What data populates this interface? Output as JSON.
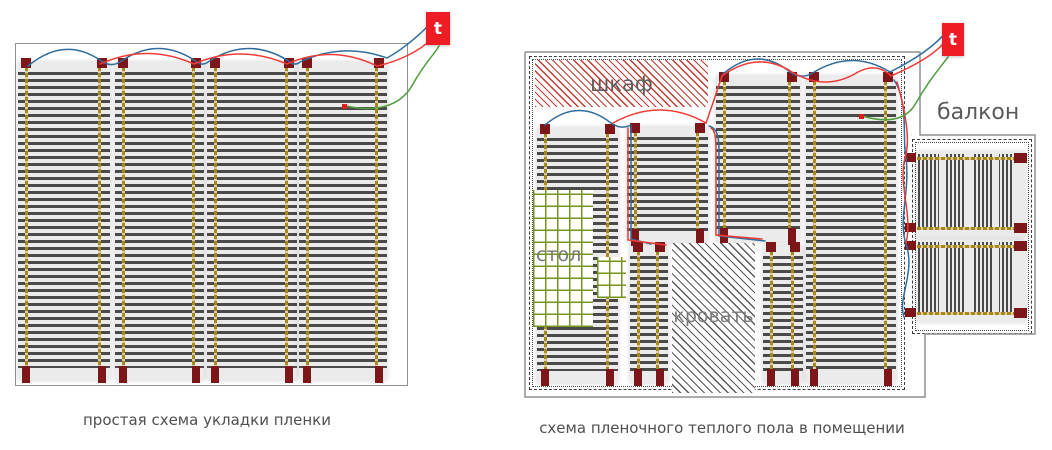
{
  "left_diagram": {
    "caption": "простая схема укладки пленки",
    "caption_pos": {
      "x": 7,
      "y": 411,
      "w": 400
    },
    "thermostat": {
      "label": "t",
      "x": 426,
      "y": 12,
      "w": 24,
      "h": 33
    },
    "border": {
      "x": 15,
      "y": 43,
      "w": 391,
      "h": 341
    },
    "strips": [
      {
        "x": 18,
        "y": 62,
        "w": 92,
        "h": 318
      },
      {
        "x": 115,
        "y": 62,
        "w": 89,
        "h": 318
      },
      {
        "x": 207,
        "y": 62,
        "w": 90,
        "h": 318
      },
      {
        "x": 299,
        "y": 62,
        "w": 88,
        "h": 318
      }
    ],
    "sensor": {
      "x": 342,
      "y": 104
    },
    "wires": {
      "blue": [
        "M28,66 Q64,36 100,60 Q110,68 120,62 Q157,36 194,60 Q201,67 208,62 Q247,36 287,60 Q294,67 300,62 Q343,42 387,58 C405,48 418,36 428,26"
      ],
      "red": [
        "M100,64 Q147,43 194,64 Q240,44 287,64 Q332,44 377,66 C400,61 421,50 430,40"
      ],
      "green": [
        "M346,106 C374,112 400,108 413,84 C424,64 433,56 439,46"
      ]
    }
  },
  "right_diagram": {
    "caption": "схема пленочного теплого пола в помещении",
    "caption_pos": {
      "x": 522,
      "y": 419,
      "w": 400
    },
    "thermostat": {
      "label": "t",
      "x": 942,
      "y": 23,
      "w": 22,
      "h": 33
    },
    "outline_points": "525,52 920,52 920,135 1035,135 1035,334 925,334 925,397 525,397 525,52",
    "room_border": {
      "x": 529,
      "y": 56,
      "w": 374,
      "h": 332
    },
    "room_inner_border": {
      "x": 532,
      "y": 59,
      "w": 368,
      "h": 326
    },
    "wardrobe": {
      "label": "шкаф",
      "x": 535,
      "y": 60,
      "w": 173,
      "h": 47
    },
    "table": {
      "label": "стол",
      "main": {
        "x": 533,
        "y": 190,
        "w": 60,
        "h": 137
      },
      "patch": {
        "x": 597,
        "y": 257,
        "w": 29,
        "h": 41
      },
      "label_pos": {
        "x": 536,
        "y": 244
      }
    },
    "bed": {
      "label": "кровать",
      "x": 672,
      "y": 243,
      "w": 83,
      "h": 150
    },
    "balcony": {
      "label": "балкон",
      "border": {
        "x": 912,
        "y": 139,
        "w": 118,
        "h": 193
      },
      "inner_border": {
        "x": 915,
        "y": 142,
        "w": 112,
        "h": 187
      },
      "label_pos": {
        "x": 937,
        "y": 100
      }
    },
    "strips": [
      {
        "x": 537,
        "y": 128,
        "w": 81,
        "h": 255
      },
      {
        "x": 627,
        "y": 127,
        "w": 81,
        "h": 116
      },
      {
        "x": 630,
        "y": 246,
        "w": 38,
        "h": 137
      },
      {
        "x": 716,
        "y": 76,
        "w": 84,
        "h": 166
      },
      {
        "x": 763,
        "y": 246,
        "w": 40,
        "h": 137
      },
      {
        "x": 806,
        "y": 76,
        "w": 90,
        "h": 307
      }
    ],
    "balcony_strips": [
      {
        "x": 916,
        "y": 152,
        "w": 110,
        "h": 85
      },
      {
        "x": 916,
        "y": 240,
        "w": 110,
        "h": 82
      }
    ],
    "sensor": {
      "x": 859,
      "y": 114
    },
    "wires": {
      "blue": [
        "M545,125 Q578,97 611,123 Q621,130 631,125",
        "M631,127 L631,239 L651,244",
        "M709,126 C716,128 719,134 719,150 L719,236 L765,241",
        "M723,74 Q757,45 790,72 Q800,79 811,74 Q851,48 890,72 C914,60 935,46 947,31",
        "M894,80 C909,102 902,140 906,157 C910,192 899,216 905,241 C917,272 897,297 904,317"
      ],
      "red": [
        "M613,123 Q660,97 706,123",
        "M628,128 L628,240 L666,245",
        "M706,123 C713,103 718,88 722,76",
        "M722,76 Q758,50 792,72 Q826,92 858,72 Q877,62 891,76 C914,66 933,55 943,44",
        "M711,128 C716,131 716,140 716,155 L716,235 L762,239",
        "M897,82 C905,110 911,140 905,158 C898,185 913,215 906,243"
      ],
      "green": [
        "M862,116 C886,123 906,121 916,103 C929,80 940,68 948,57"
      ]
    }
  },
  "colors": {
    "wire_blue": "#2f6d9d",
    "wire_red": "#ef3b35",
    "wire_green": "#4f9d3c",
    "thermostat_red": "#ee1c25",
    "connector_maroon": "#7d1619",
    "bus_olive": "#a8881e",
    "film_background": "#ebebeb",
    "stripe_dark": "#4a4a4a",
    "hatch_red": "#c23b2e",
    "grid_green": "#76951c",
    "outline_gray": "#919191"
  }
}
